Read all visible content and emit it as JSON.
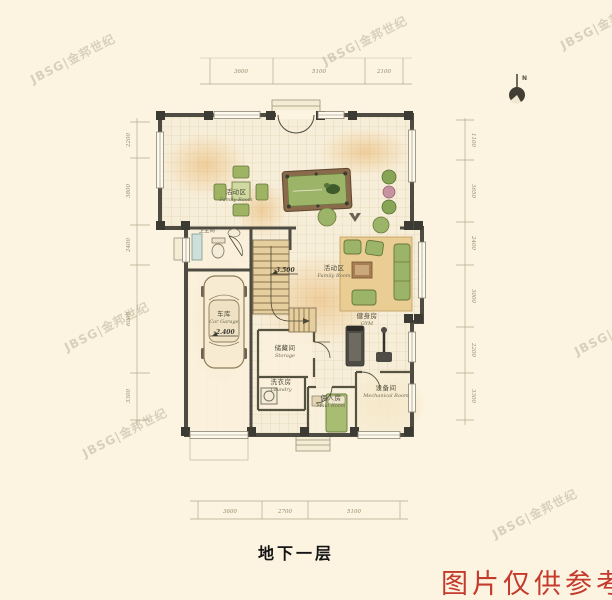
{
  "title": "地下一层",
  "stamp": "图片仅供参考",
  "watermark": "JBSG|金邦世纪",
  "compass": {
    "label": "N"
  },
  "elevations": {
    "family_room": "-3.500",
    "garage": "-2.400"
  },
  "rooms": {
    "family_upper": {
      "cn": "活动区",
      "en": "Family Room"
    },
    "family_center": {
      "cn": "活动区",
      "en": "Family Room"
    },
    "bathroom": {
      "cn": "卫生间"
    },
    "garage": {
      "cn": "车库",
      "en": "Car Garage"
    },
    "storage": {
      "cn": "储藏间",
      "en": "Storage"
    },
    "laundry": {
      "cn": "洗衣房",
      "en": "Laundry"
    },
    "gym": {
      "cn": "健身房",
      "en": "GYM"
    },
    "maid": {
      "cn": "佣人房",
      "en": "Maid Room"
    },
    "mechanical": {
      "cn": "设备间",
      "en": "Mechanical Room"
    }
  },
  "dimensions": {
    "top": [
      "3600",
      "5100",
      "2100"
    ],
    "bottom": [
      "3600",
      "2700",
      "5100"
    ],
    "left": [
      "2200",
      "3800",
      "2400",
      "6000",
      "3300"
    ],
    "right": [
      "1100",
      "3650",
      "2400",
      "3000",
      "2200",
      "3300"
    ]
  },
  "colors": {
    "stamp_red": "#c43a2c",
    "wall": "#4d4b42",
    "accent_green": "#9cb468"
  }
}
